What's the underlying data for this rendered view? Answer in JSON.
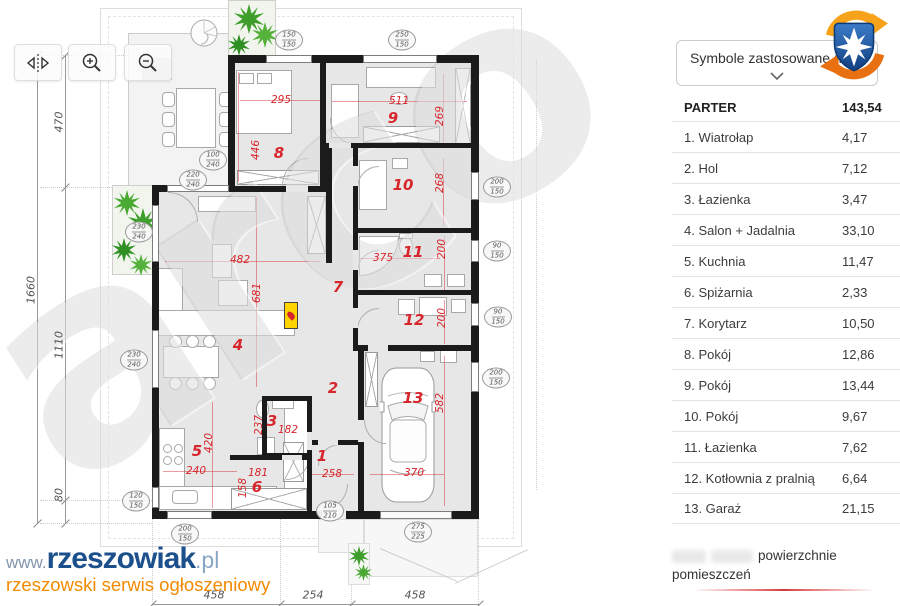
{
  "toolbar": {
    "buttons": [
      "flip-horizontal-icon",
      "zoom-in-icon",
      "zoom-out-icon"
    ]
  },
  "legend_dropdown": {
    "label": "Symbole zastosowane na",
    "collapsed": true
  },
  "brand_badge": {
    "icon": "shield-cross-swirl-logo",
    "shield_color": "#1d5aa8",
    "swirl_color": "#f18a1e"
  },
  "area_table": {
    "title": "PARTER",
    "total": "143,54",
    "rows": [
      {
        "label": "1. Wiatrołap",
        "value": "4,17"
      },
      {
        "label": "2. Hol",
        "value": "7,12"
      },
      {
        "label": "3. Łazienka",
        "value": "3,47"
      },
      {
        "label": "4. Salon + Jadalnia",
        "value": "33,10"
      },
      {
        "label": "5. Kuchnia",
        "value": "11,47"
      },
      {
        "label": "6. Spiżarnia",
        "value": "2,33"
      },
      {
        "label": "7. Korytarz",
        "value": "10,50"
      },
      {
        "label": "8. Pokój",
        "value": "12,86"
      },
      {
        "label": "9. Pokój",
        "value": "13,44"
      },
      {
        "label": "10. Pokój",
        "value": "9,67"
      },
      {
        "label": "11. Łazienka",
        "value": "7,62"
      },
      {
        "label": "12. Kotłownia z pralnią",
        "value": "6,64"
      },
      {
        "label": "13. Garaż",
        "value": "21,15"
      }
    ],
    "footnote": "powierzchnie pomieszczeń"
  },
  "site_logo": {
    "prefix": "www.",
    "name": "rzeszowiak",
    "suffix": ".pl",
    "tagline": "rzeszowski serwis ogłoszeniowy"
  },
  "plan": {
    "watermark": "arco",
    "colors": {
      "dimension_red": "#d7262c",
      "wall_black": "#1b1b1b",
      "floor_gray": "#e7e7e7",
      "plant_green": "#46a52e",
      "fireplace_yellow": "#ffd400"
    },
    "room_numbers": [
      {
        "n": "1",
        "x": 322,
        "y": 456
      },
      {
        "n": "2",
        "x": 333,
        "y": 388
      },
      {
        "n": "3",
        "x": 272,
        "y": 421
      },
      {
        "n": "4",
        "x": 238,
        "y": 345
      },
      {
        "n": "5",
        "x": 197,
        "y": 451
      },
      {
        "n": "6",
        "x": 257,
        "y": 487
      },
      {
        "n": "7",
        "x": 338,
        "y": 287
      },
      {
        "n": "8",
        "x": 279,
        "y": 153
      },
      {
        "n": "9",
        "x": 393,
        "y": 118
      },
      {
        "n": "10",
        "x": 403,
        "y": 185
      },
      {
        "n": "11",
        "x": 413,
        "y": 252
      },
      {
        "n": "12",
        "x": 414,
        "y": 320
      },
      {
        "n": "13",
        "x": 413,
        "y": 398
      }
    ],
    "dimensions": [
      {
        "t": "295",
        "x": 281,
        "y": 100
      },
      {
        "t": "446",
        "x": 256,
        "y": 150,
        "v": 1
      },
      {
        "t": "511",
        "x": 399,
        "y": 101
      },
      {
        "t": "269",
        "x": 440,
        "y": 116,
        "v": 1
      },
      {
        "t": "268",
        "x": 440,
        "y": 183,
        "v": 1
      },
      {
        "t": "375",
        "x": 383,
        "y": 258
      },
      {
        "t": "200",
        "x": 442,
        "y": 249,
        "v": 1
      },
      {
        "t": "200",
        "x": 442,
        "y": 318,
        "v": 1
      },
      {
        "t": "482",
        "x": 240,
        "y": 260
      },
      {
        "t": "681",
        "x": 257,
        "y": 293,
        "v": 1
      },
      {
        "t": "237",
        "x": 259,
        "y": 425,
        "v": 1
      },
      {
        "t": "182",
        "x": 288,
        "y": 430
      },
      {
        "t": "420",
        "x": 209,
        "y": 443,
        "v": 1
      },
      {
        "t": "240",
        "x": 196,
        "y": 471
      },
      {
        "t": "158",
        "x": 243,
        "y": 488,
        "v": 1
      },
      {
        "t": "181",
        "x": 258,
        "y": 473
      },
      {
        "t": "258",
        "x": 332,
        "y": 474
      },
      {
        "t": "370",
        "x": 414,
        "y": 473
      },
      {
        "t": "582",
        "x": 440,
        "y": 403,
        "v": 1
      }
    ],
    "openings": [
      {
        "a": "150",
        "b": "150",
        "x": 289,
        "y": 40
      },
      {
        "a": "250",
        "b": "150",
        "x": 402,
        "y": 40
      },
      {
        "a": "100",
        "b": "240",
        "x": 213,
        "y": 160
      },
      {
        "a": "220",
        "b": "240",
        "x": 193,
        "y": 180
      },
      {
        "a": "230",
        "b": "240",
        "x": 139,
        "y": 232
      },
      {
        "a": "230",
        "b": "240",
        "x": 134,
        "y": 360
      },
      {
        "a": "120",
        "b": "150",
        "x": 136,
        "y": 501
      },
      {
        "a": "200",
        "b": "150",
        "x": 185,
        "y": 534
      },
      {
        "a": "105",
        "b": "210",
        "x": 330,
        "y": 511
      },
      {
        "a": "275",
        "b": "225",
        "x": 418,
        "y": 532
      },
      {
        "a": "200",
        "b": "150",
        "x": 497,
        "y": 187
      },
      {
        "a": "90",
        "b": "150",
        "x": 497,
        "y": 251
      },
      {
        "a": "90",
        "b": "150",
        "x": 498,
        "y": 317
      },
      {
        "a": "200",
        "b": "150",
        "x": 496,
        "y": 378
      }
    ],
    "site_dimensions": [
      {
        "t": "1660",
        "x": 31,
        "y": 290,
        "v": 1
      },
      {
        "t": "470",
        "x": 59,
        "y": 122,
        "v": 1
      },
      {
        "t": "1110",
        "x": 59,
        "y": 345,
        "v": 1
      },
      {
        "t": "80",
        "x": 59,
        "y": 495,
        "v": 1
      },
      {
        "t": "458",
        "x": 214,
        "y": 595
      },
      {
        "t": "254",
        "x": 313,
        "y": 595
      },
      {
        "t": "458",
        "x": 415,
        "y": 595
      }
    ]
  }
}
